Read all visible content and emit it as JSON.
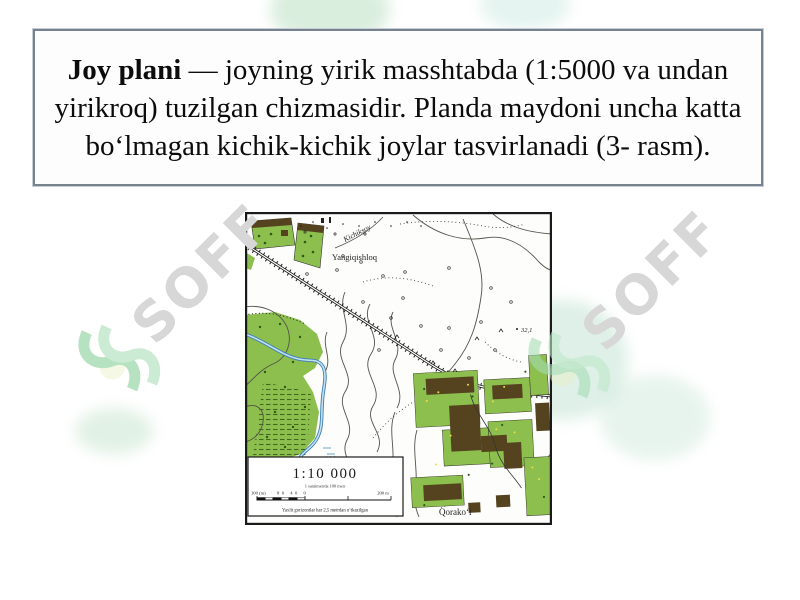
{
  "definition": {
    "term": "Joy plani",
    "body": " — joyning yirik masshtabda (1:5000 va undan yirikroq) tuzilgan chizmasidir. Planda maydoni uncha katta bo‘lmagan kichik-kichik joylar tasvirlanadi (3- rasm)."
  },
  "map": {
    "labels": {
      "stream": "Kichiksoy",
      "village_top": "Yangiqishloq",
      "village_bottom": "Qorako‘l",
      "elevation": "32,1"
    },
    "scale": {
      "ratio": "1:10 000",
      "subtitle": "1 santimetrda 100 metr",
      "bar_left": "100 (m)",
      "bar_mid": "80 40 0",
      "bar_right": "200 m",
      "footnote": "Yaxlit gorizontlar har 2,5 metrdan o‘tkazilgan"
    }
  },
  "watermark": {
    "text": "SOFF"
  },
  "colors": {
    "field_green": "#8cbf4e",
    "building_brown": "#55431f",
    "river_blue": "#4a88b8",
    "box_border": "#77828f",
    "watermark_green": "#a6dcb4",
    "watermark_gray": "#d7d7d7"
  }
}
